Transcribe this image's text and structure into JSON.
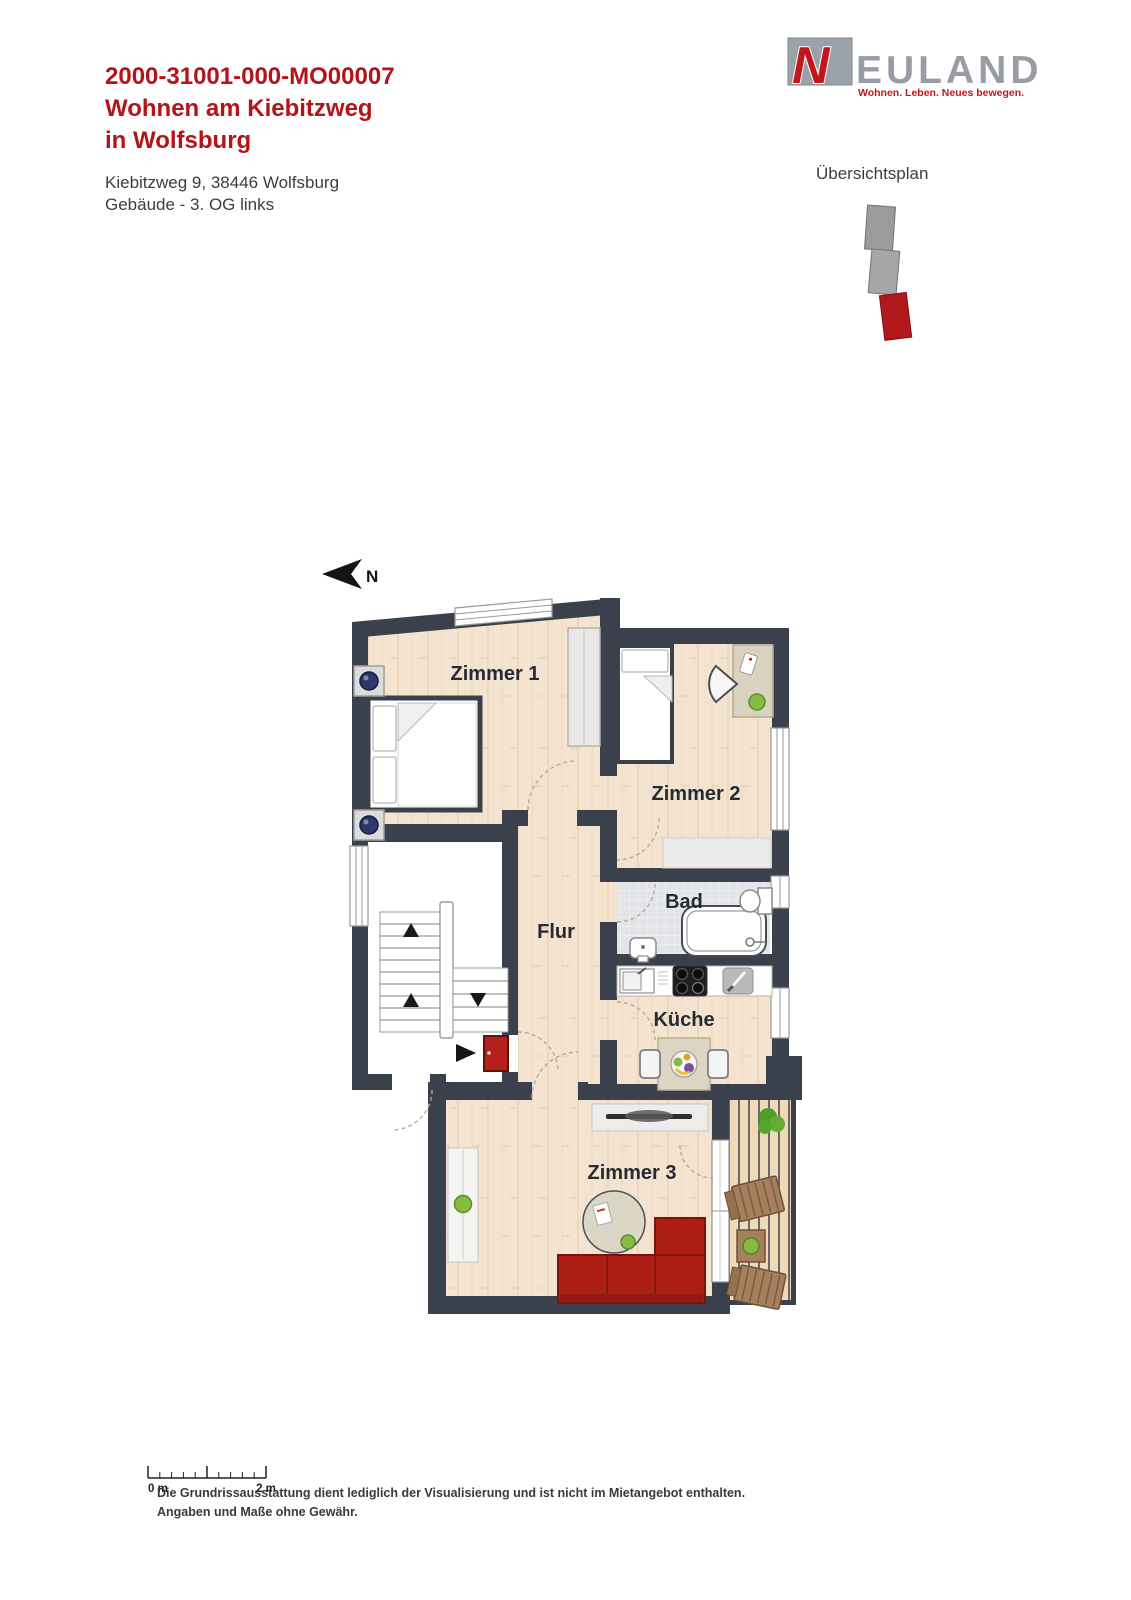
{
  "header": {
    "code": "2000-31001-000-MO00007",
    "title_line1": "Wohnen am Kiebitzweg",
    "title_line2": "in Wolfsburg",
    "address": "Kiebitzweg 9, 38446 Wolfsburg",
    "unit": "Gebäude - 3. OG links"
  },
  "logo": {
    "letter": "N",
    "wordmark": "EULAND",
    "tagline": "Wohnen. Leben. Neues bewegen.",
    "brand_red": "#c3161c",
    "brand_gray": "#979ca5"
  },
  "overview": {
    "label": "Übersichtsplan"
  },
  "compass": {
    "label": "N"
  },
  "plan": {
    "rooms": [
      {
        "label": "Zimmer 1"
      },
      {
        "label": "Zimmer 2"
      },
      {
        "label": "Bad"
      },
      {
        "label": "Flur"
      },
      {
        "label": "Küche"
      },
      {
        "label": "Zimmer 3"
      }
    ],
    "colors": {
      "wall": "#3b404d",
      "wood_floor": "#f3e3cf",
      "tile_floor": "#e2e4e7",
      "deck_floor": "#eed9b9",
      "accent_red": "#b5201a"
    }
  },
  "scale_bar": {
    "start_label": "0 m",
    "end_label": "2 m"
  },
  "disclaimer": {
    "line1": "Die Grundrissausstattung dient lediglich der Visualisierung und ist nicht im Mietangebot enthalten.",
    "line2": "Angaben und Maße ohne Gewähr."
  }
}
